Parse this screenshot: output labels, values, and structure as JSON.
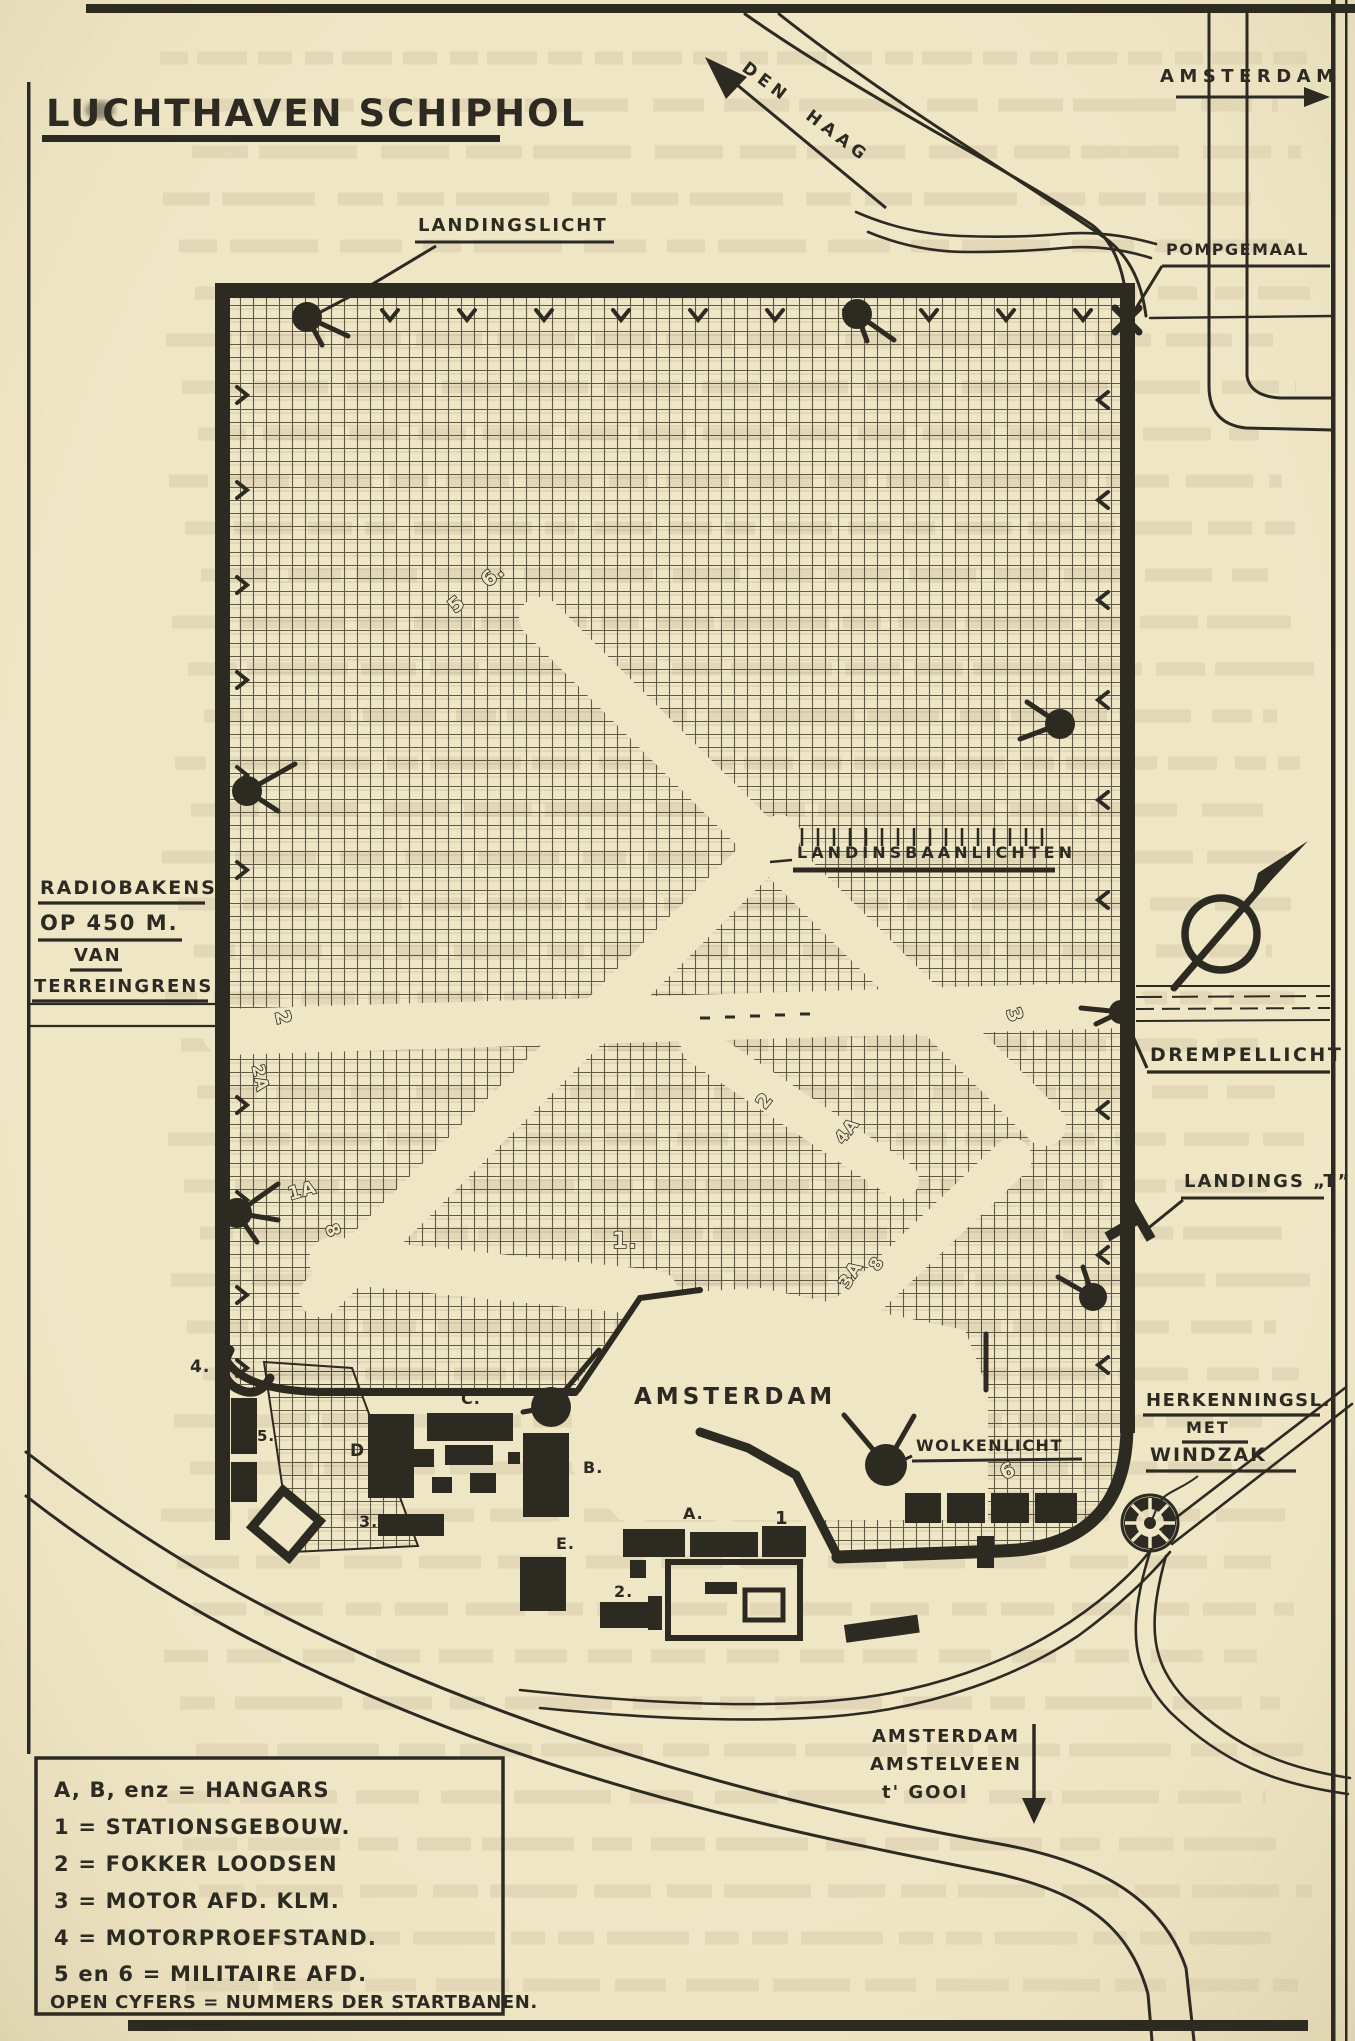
{
  "document": {
    "title": "LUCHTHAVEN SCHIPHOL"
  },
  "map": {
    "directions": {
      "den_haag": "DEN HAAG",
      "amsterdam_north": "AMSTERDAM",
      "south_line1": "AMSTERDAM",
      "south_line2": "AMSTELVEEN",
      "south_line3": "t' GOOI"
    },
    "labels": {
      "landingslicht": "LANDINGSLICHT",
      "pompgemaal": "POMPGEMAAL",
      "landingsbaanlichten": "LANDINSBAANLICHTEN",
      "radiobakens_line1": "RADIOBAKENS",
      "radiobakens_line2": "OP 450 M.",
      "radiobakens_line3": "VAN",
      "radiobakens_line4": "TERREINGRENS",
      "drempellicht": "DREMPELLICHT",
      "landings_t": "LANDINGS „T”",
      "wolkenlicht": "WOLKENLICHT",
      "herkenning_line1": "HERKENNINGSL.",
      "herkenning_line2": "MET",
      "herkenning_line3": "WINDZAK",
      "apron": "AMSTERDAM"
    },
    "building_labels": {
      "a": "A.",
      "b": "B.",
      "c": "C.",
      "d": "D",
      "e": "E.",
      "n1": "1",
      "n2": "2.",
      "n3": "3.",
      "n4": "4.",
      "n5": "5."
    },
    "runway_numbers": [
      "6.",
      "5",
      "2",
      "2A",
      "3",
      "1.",
      "1A",
      "8",
      "2",
      "4A",
      "3A",
      "8",
      "6"
    ]
  },
  "legend": {
    "items": [
      "A, B, enz = HANGARS",
      "1 = STATIONSGEBOUW.",
      "2 = FOKKER LOODSEN",
      "3 = MOTOR AFD. KLM.",
      "4 = MOTORPROEFSTAND.",
      "5 en 6 = MILITAIRE AFD.",
      "OPEN CYFERS = NUMMERS DER STARTBANEN."
    ]
  },
  "colors": {
    "paper": "#efe6c6",
    "ink": "#2d2a22"
  }
}
